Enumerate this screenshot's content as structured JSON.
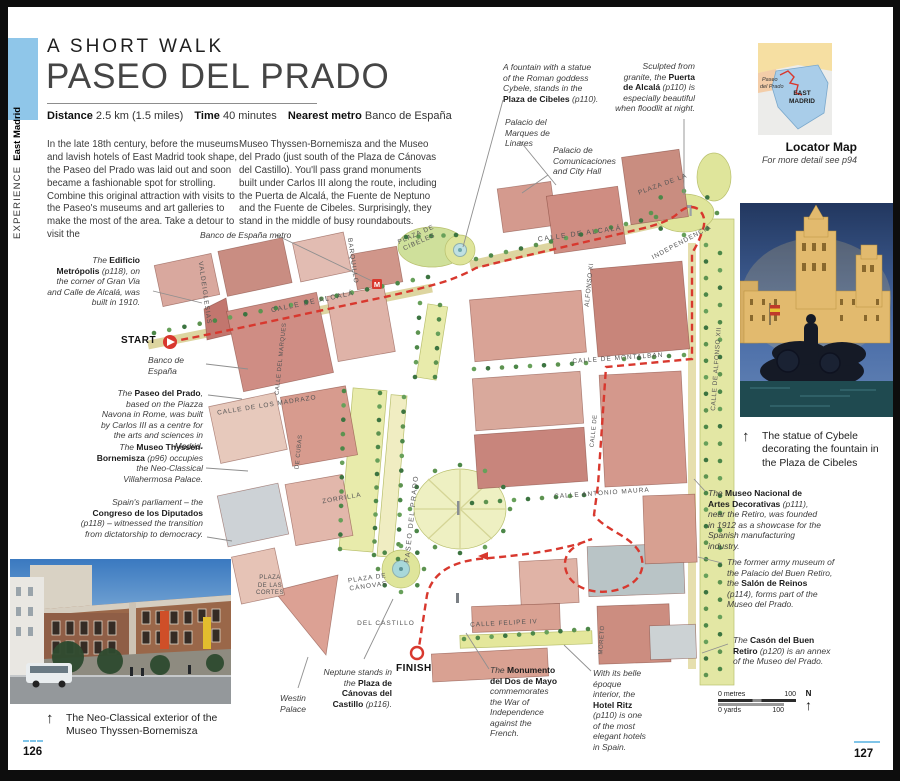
{
  "page": {
    "left_page_number": "126",
    "right_page_number": "127"
  },
  "sidebar": {
    "section": "EXPERIENCE",
    "chapter": "East Madrid"
  },
  "header": {
    "kicker": "A SHORT WALK",
    "title": "PASEO DEL PRADO",
    "info": [
      {
        "label": "Distance",
        "value": "2.5 km (1.5 miles)"
      },
      {
        "label": "Time",
        "value": "40 minutes"
      },
      {
        "label": "Nearest metro",
        "value": "Banco de España"
      }
    ],
    "intro_col1": "In the late 18th century, before the museums and lavish hotels of East Madrid took shape, the Paseo del Prado was laid out and soon became a fashionable spot for strolling. Combine this original attraction with visits to the Paseo's museums and art galleries to make the most of the area. Take a detour to visit the",
    "intro_col2": "Museo Thyssen-Bornemisza and the Museo del Prado (just south of the Plaza de Cánovas del Castillo). You'll pass grand monuments built under Carlos III along the route, including the Puerta de Alcalá, the Fuente de Neptuno and the Fuente de Cibeles. Surprisingly, they stand in the middle of busy roundabouts."
  },
  "locator": {
    "east1": "EAST",
    "east2": "MADRID",
    "paseo1": "Paseo",
    "paseo2": "del Prado",
    "caption_title": "Locator Map",
    "caption_sub": "For more detail see p94"
  },
  "photos": {
    "cybele_caption": "The statue of Cybele decorating the fountain in the Plaza de Cibeles",
    "thyssen_caption": "The Neo-Classical exterior of the Museo Thyssen-Bornemisza",
    "arrow": "↑"
  },
  "map": {
    "start_label": "START",
    "finish_label": "FINISH",
    "metro_icon": "M",
    "scale": {
      "metres_left": "0 metres",
      "metres_right": "100",
      "yards_left": "0 yards",
      "yards_right": "100",
      "north": "N",
      "north_arrow": "↑"
    },
    "street_labels": [
      {
        "id": "calle-de-alcala-west",
        "t": "CALLE DE ALCALÁ",
        "x": 305,
        "y": 296,
        "rot": -12,
        "s": 7,
        "ls": 1.5
      },
      {
        "id": "calle-de-alcala-east",
        "t": "CALLE DE ALCALÁ",
        "x": 572,
        "y": 228,
        "rot": -8,
        "s": 7,
        "ls": 1.5
      },
      {
        "id": "barquillo",
        "t": "BARQUILLO",
        "x": 344,
        "y": 254,
        "rot": 82,
        "s": 6.5,
        "ls": 1
      },
      {
        "id": "valdeiglesias",
        "t": "VALDEIGLESIAS",
        "x": 196,
        "y": 286,
        "rot": 82,
        "s": 6.5,
        "ls": 1
      },
      {
        "id": "calle-del-marques",
        "t": "CALLE DEL MARQUES",
        "x": 274,
        "y": 352,
        "rot": -84,
        "s": 6,
        "ls": 0.5
      },
      {
        "id": "de-cubas",
        "t": "DE CUBAS",
        "x": 292,
        "y": 445,
        "rot": -84,
        "s": 6,
        "ls": 0.5
      },
      {
        "id": "calle-de-los-madrazo",
        "t": "CALLE DE LOS MADRAZO",
        "x": 259,
        "y": 399,
        "rot": -9,
        "s": 6.5,
        "ls": 1
      },
      {
        "id": "zorrilla",
        "t": "ZORRILLA",
        "x": 334,
        "y": 492,
        "rot": -10,
        "s": 6.5,
        "ls": 1
      },
      {
        "id": "paseo-del-prado",
        "t": "PASEO DEL PRADO",
        "x": 405,
        "y": 512,
        "rot": -84,
        "s": 7,
        "ls": 1.5
      },
      {
        "id": "plaza-de-cibeles",
        "t": "PLAZA DE\nCIBELES",
        "x": 410,
        "y": 232,
        "rot": -24,
        "s": 6.5,
        "ls": 1
      },
      {
        "id": "plaza-de-la",
        "t": "PLAZA DE LA",
        "x": 655,
        "y": 178,
        "rot": -20,
        "s": 6.5,
        "ls": 1
      },
      {
        "id": "independencia",
        "t": "INDEPENDENCIA",
        "x": 674,
        "y": 236,
        "rot": -28,
        "s": 6.5,
        "ls": 1
      },
      {
        "id": "alfonso-xi",
        "t": "ALFONSO XI",
        "x": 582,
        "y": 278,
        "rot": -84,
        "s": 6.5,
        "ls": 0.5
      },
      {
        "id": "calle-de-montalban",
        "t": "CALLE DE MONTALBAN",
        "x": 610,
        "y": 352,
        "rot": -4,
        "s": 6.5,
        "ls": 1
      },
      {
        "id": "calle-de-alfonso-xii",
        "t": "CALLE DE ALFONSO XII",
        "x": 709,
        "y": 362,
        "rot": -86,
        "s": 6.5,
        "ls": 0.5
      },
      {
        "id": "calle-antonio-maura",
        "t": "CALLE ANTONIO MAURA",
        "x": 594,
        "y": 487,
        "rot": -4,
        "s": 6.5,
        "ls": 1
      },
      {
        "id": "calle-de",
        "t": "CALLE DE",
        "x": 587,
        "y": 424,
        "rot": -84,
        "s": 6,
        "ls": 0.5
      },
      {
        "id": "moreto",
        "t": "MORETO",
        "x": 595,
        "y": 633,
        "rot": -86,
        "s": 6,
        "ls": 0.5
      },
      {
        "id": "calle-felipe-iv",
        "t": "CALLE FELIPE IV",
        "x": 496,
        "y": 617,
        "rot": -3,
        "s": 6.5,
        "ls": 1
      },
      {
        "id": "plaza-de-las-cortes",
        "t": "PLAZA\nDE LAS\nCORTES",
        "x": 262,
        "y": 579,
        "rot": 0,
        "s": 6,
        "ls": 0.5
      },
      {
        "id": "plaza-de-canovas",
        "t": "PLAZA DE\nCÁNOVAS",
        "x": 360,
        "y": 576,
        "rot": -8,
        "s": 6.5,
        "ls": 1
      },
      {
        "id": "del-castillo",
        "t": "DEL CASTILLO",
        "x": 378,
        "y": 617,
        "rot": 0,
        "s": 6.5,
        "ls": 1
      }
    ],
    "annotations": [
      {
        "id": "plaza-de-cibeles",
        "x": 495,
        "y": 55,
        "w": 97,
        "align": "left",
        "segments": [
          {
            "t": "A fountain with a statue of the Roman goddess Cybele, stands in the "
          },
          {
            "t": "Plaza de Cibeles",
            "b": true
          },
          {
            "t": " (p110)."
          }
        ]
      },
      {
        "id": "puerta-de-alcala",
        "x": 605,
        "y": 54,
        "w": 82,
        "align": "right",
        "segments": [
          {
            "t": "Sculpted from granite, the "
          },
          {
            "t": "Puerta de Alcalá",
            "b": true
          },
          {
            "t": " (p110) is especially beautiful when floodlit at night."
          }
        ]
      },
      {
        "id": "palacio-linares",
        "x": 497,
        "y": 110,
        "w": 66,
        "align": "left",
        "segments": [
          {
            "t": "Palacio del Marques de Linares"
          }
        ]
      },
      {
        "id": "palacio-comunicaciones",
        "x": 545,
        "y": 138,
        "w": 60,
        "align": "left",
        "segments": [
          {
            "t": "Palacio de Comunicaciones and City Hall"
          }
        ]
      },
      {
        "id": "banco-metro",
        "x": 192,
        "y": 223,
        "w": 110,
        "align": "left",
        "segments": [
          {
            "t": "Banco de España metro"
          }
        ]
      },
      {
        "id": "edificio-metropolis",
        "x": 39,
        "y": 248,
        "w": 93,
        "align": "right",
        "segments": [
          {
            "t": "The "
          },
          {
            "t": "Edificio Metrópolis",
            "b": true
          },
          {
            "t": " (p118), on the corner of Gran Via and Calle de Alcalá, was built in 1910."
          }
        ]
      },
      {
        "id": "banco-de-espana",
        "x": 140,
        "y": 348,
        "w": 60,
        "align": "left",
        "segments": [
          {
            "t": "Banco de España"
          }
        ]
      },
      {
        "id": "paseo-del-prado",
        "x": 90,
        "y": 381,
        "w": 105,
        "align": "right",
        "segments": [
          {
            "t": "The "
          },
          {
            "t": "Paseo del Prado",
            "b": true
          },
          {
            "t": ", based on the Piazza Navona in Rome, was built by Carlos III as a centre for the arts and sciences in Madrid."
          }
        ]
      },
      {
        "id": "museo-thyssen",
        "x": 84,
        "y": 435,
        "w": 111,
        "align": "right",
        "segments": [
          {
            "t": "The "
          },
          {
            "t": "Museo Thyssen-Bornemisza",
            "b": true
          },
          {
            "t": " (p96) occupies the Neo-Classical Villahermosa Palace."
          }
        ]
      },
      {
        "id": "congreso",
        "x": 72,
        "y": 490,
        "w": 123,
        "align": "right",
        "segments": [
          {
            "t": "Spain's parliament – the "
          },
          {
            "t": "Congreso de los Diputados",
            "b": true
          },
          {
            "t": " (p118) – witnessed the transition from dictatorship to democracy."
          }
        ]
      },
      {
        "id": "westin-palace",
        "x": 272,
        "y": 686,
        "w": 42,
        "align": "left",
        "segments": [
          {
            "t": "Westin Palace"
          }
        ]
      },
      {
        "id": "neptune",
        "x": 312,
        "y": 660,
        "w": 72,
        "align": "right",
        "segments": [
          {
            "t": "Neptune stands in the "
          },
          {
            "t": "Plaza de Cánovas del Castillo",
            "b": true
          },
          {
            "t": " (p116)."
          }
        ]
      },
      {
        "id": "monumento-dos-de-mayo",
        "x": 482,
        "y": 658,
        "w": 72,
        "align": "left",
        "segments": [
          {
            "t": "The "
          },
          {
            "t": "Monumento del Dos de Mayo",
            "b": true
          },
          {
            "t": " commemorates the War of Independence against the French."
          }
        ]
      },
      {
        "id": "hotel-ritz",
        "x": 585,
        "y": 661,
        "w": 54,
        "align": "left",
        "segments": [
          {
            "t": "With its belle époque interior, the "
          },
          {
            "t": "Hotel Ritz",
            "b": true
          },
          {
            "t": " (p110) is one of the most elegant hotels in Spain."
          }
        ]
      },
      {
        "id": "artes-decorativas",
        "x": 700,
        "y": 481,
        "w": 115,
        "align": "left",
        "segments": [
          {
            "t": "The "
          },
          {
            "t": "Museo Nacional de Artes Decorativas",
            "b": true
          },
          {
            "t": " (p111), near the Retiro, was founded in 1912 as a showcase for the Spanish manufacturing industry."
          }
        ]
      },
      {
        "id": "salon-de-reinos",
        "x": 719,
        "y": 550,
        "w": 108,
        "align": "left",
        "segments": [
          {
            "t": "The former army museum of the Palacio del Buen Retiro, the "
          },
          {
            "t": "Salón de Reinos",
            "b": true
          },
          {
            "t": " (p114), forms part of the Museo del Prado."
          }
        ]
      },
      {
        "id": "cason-del-buen-retiro",
        "x": 725,
        "y": 628,
        "w": 102,
        "align": "left",
        "segments": [
          {
            "t": "The "
          },
          {
            "t": "Casón del Buen Retiro",
            "b": true
          },
          {
            "t": " (p120) is an annex of the Museo del Prado."
          }
        ]
      }
    ]
  },
  "colors": {
    "route_red": "#d8382e",
    "accent_blue": "#7fc4e8",
    "sidebar_blue": "#8fc6e9",
    "map_green": "#e4e79b",
    "building_pink": "#d9a396",
    "locator_blue": "#a9cde9",
    "locator_yellow": "#f6dfa2"
  }
}
